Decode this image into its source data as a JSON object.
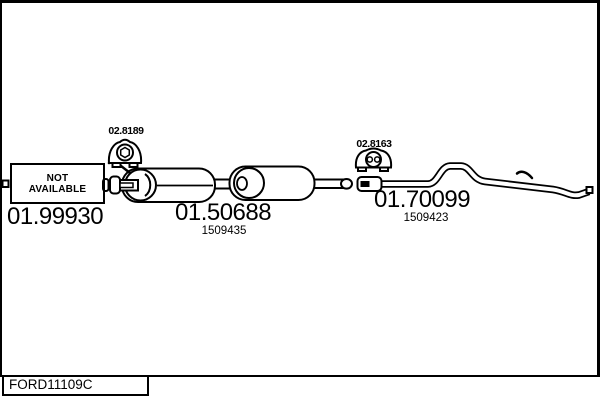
{
  "page": {
    "background": "#ffffff",
    "line_color": "#000000"
  },
  "footer": {
    "code": "FORD11109C"
  },
  "not_available_box": {
    "line1": "NOT",
    "line2": "AVAILABLE"
  },
  "parts": [
    {
      "number": "01.99930"
    },
    {
      "number": "01.50688",
      "ref": "1509435"
    },
    {
      "number": "01.70099",
      "ref": "1509423"
    }
  ],
  "mountings": [
    {
      "number": "02.8189",
      "icon": "rubber-hanger-one-hole-icon"
    },
    {
      "number": "02.8163",
      "icon": "rubber-hanger-two-hole-icon"
    }
  ]
}
